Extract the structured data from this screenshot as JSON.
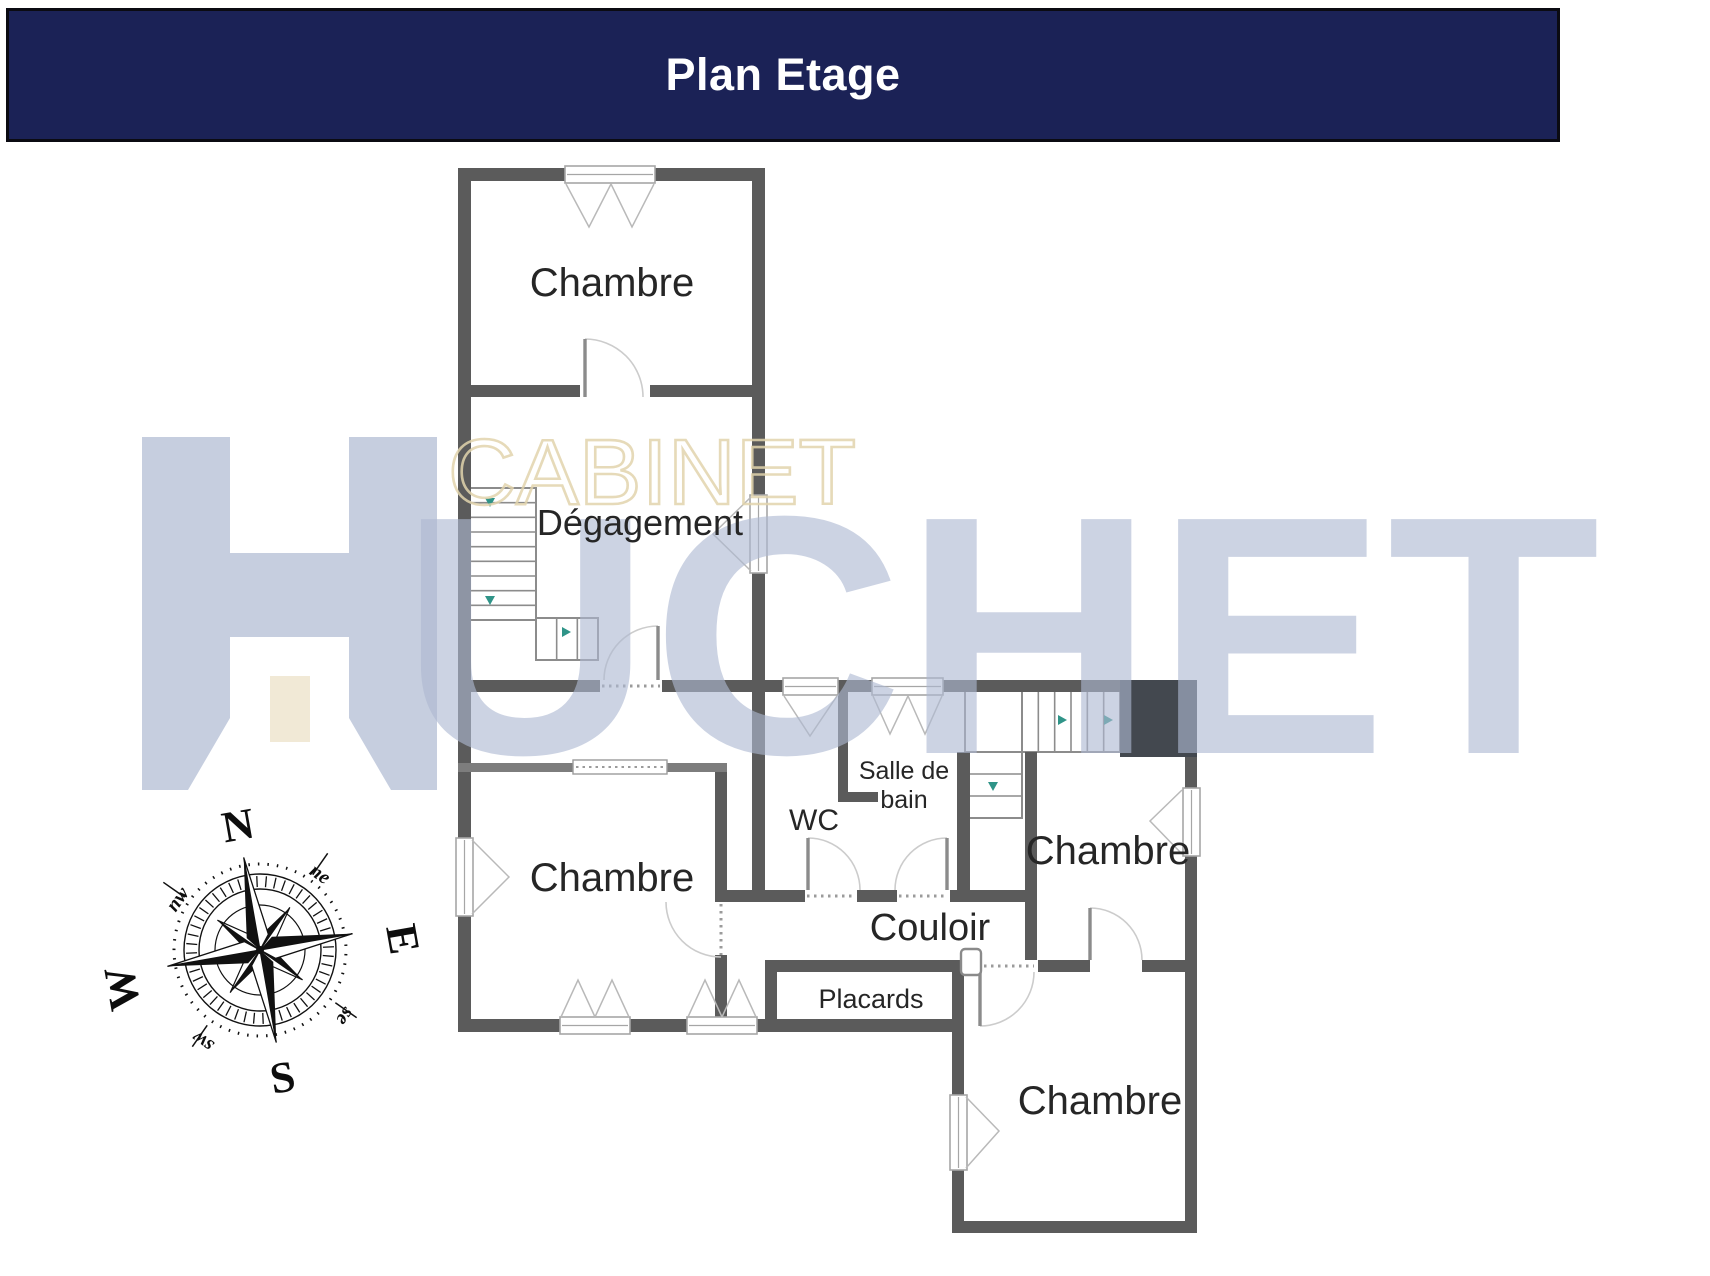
{
  "header": {
    "title": "Plan Etage",
    "bg": "#1b2256",
    "text_color": "#ffffff"
  },
  "watermark": {
    "word_top": "CABINET",
    "logo_letter": "H",
    "word_main_rest": "UCHET",
    "cream_color": "#e2d4ad",
    "blue_color": "#aeb9d2",
    "door_color": "#f0e8d4"
  },
  "compass": {
    "cx": 260,
    "cy": 950,
    "rotation": -10,
    "cardinals": {
      "n": "N",
      "e": "E",
      "s": "S",
      "w": "W"
    },
    "intercardinals": {
      "ne": "ne",
      "se": "se",
      "sw": "sw",
      "nw": "nw"
    }
  },
  "plan": {
    "wall_color": "#5b5b5b",
    "light_wall_color": "#7d7d7d",
    "block_color": "#43484f",
    "label_color": "#262626",
    "arrow_color": "#2f9488",
    "arc_color": "#cccccc",
    "leaf_color": "#8b8b8b",
    "frame_color": "#a6a6a6",
    "walls": [
      [
        458,
        168,
        307,
        13
      ],
      [
        458,
        168,
        13,
        670
      ],
      [
        458,
        916,
        13,
        115
      ],
      [
        752,
        168,
        13,
        327
      ],
      [
        752,
        573,
        13,
        317
      ],
      [
        458,
        385,
        122,
        12
      ],
      [
        650,
        385,
        115,
        12
      ],
      [
        458,
        680,
        142,
        12
      ],
      [
        662,
        680,
        121,
        12
      ],
      [
        838,
        680,
        34,
        12
      ],
      [
        943,
        680,
        254,
        12
      ],
      [
        1185,
        680,
        12,
        108
      ],
      [
        1185,
        856,
        12,
        377
      ],
      [
        838,
        692,
        10,
        110
      ],
      [
        838,
        792,
        40,
        10
      ],
      [
        957,
        752,
        13,
        138
      ],
      [
        715,
        763,
        12,
        139
      ],
      [
        715,
        955,
        12,
        67
      ],
      [
        715,
        890,
        90,
        12
      ],
      [
        857,
        890,
        40,
        12
      ],
      [
        950,
        890,
        80,
        12
      ],
      [
        765,
        972,
        12,
        50
      ],
      [
        765,
        960,
        210,
        12
      ],
      [
        1038,
        960,
        52,
        12
      ],
      [
        1142,
        960,
        55,
        12
      ],
      [
        458,
        1019,
        102,
        13
      ],
      [
        630,
        1019,
        57,
        13
      ],
      [
        757,
        1019,
        207,
        13
      ],
      [
        952,
        972,
        12,
        123
      ],
      [
        952,
        1170,
        12,
        63
      ],
      [
        952,
        1221,
        245,
        12
      ],
      [
        1025,
        752,
        12,
        208
      ]
    ],
    "light_walls": [
      [
        458,
        763,
        115,
        9
      ],
      [
        667,
        763,
        60,
        9
      ]
    ],
    "block": [
      1120,
      680,
      77,
      77
    ],
    "stairs": [
      {
        "x": 466,
        "y": 488,
        "w": 70,
        "h": 132,
        "dir": "h",
        "n": 8
      },
      {
        "x": 536,
        "y": 618,
        "w": 62,
        "h": 42,
        "dir": "v",
        "n": 2
      },
      {
        "x": 965,
        "y": 690,
        "w": 57,
        "h": 62,
        "dir": "h",
        "n": 0
      },
      {
        "x": 1022,
        "y": 690,
        "w": 98,
        "h": 62,
        "dir": "v",
        "n": 5
      },
      {
        "x": 965,
        "y": 752,
        "w": 57,
        "h": 66,
        "dir": "h",
        "n": 2
      }
    ],
    "windows": [
      {
        "rect": [
          565,
          166,
          90,
          17
        ],
        "sashes": [
          "M566,184 L589,227 L611,184",
          "M611,184 L632,227 L654,184"
        ]
      },
      {
        "rect": [
          750,
          495,
          17,
          78
        ],
        "sashes": [
          "M751,497 L713,534 L751,571"
        ]
      },
      {
        "rect": [
          456,
          838,
          17,
          78
        ],
        "sashes": [
          "M472,840 L509,877 L472,914"
        ]
      },
      {
        "rect": [
          783,
          678,
          55,
          17
        ],
        "sashes": [
          "M784,696 L810,736 L837,696"
        ]
      },
      {
        "rect": [
          872,
          678,
          71,
          17
        ],
        "sashes": [
          "M873,696 L890,734 L908,696",
          "M908,696 L925,734 L942,696"
        ]
      },
      {
        "rect": [
          1183,
          788,
          17,
          68
        ],
        "sashes": [
          "M1182,790 L1150,821 L1182,854"
        ]
      },
      {
        "rect": [
          560,
          1017,
          70,
          17
        ],
        "sashes": [
          "M561,1017 L578,980 L595,1017",
          "M595,1017 L612,980 L629,1017"
        ]
      },
      {
        "rect": [
          687,
          1017,
          70,
          17
        ],
        "sashes": [
          "M688,1017 L705,980 L722,1017",
          "M722,1017 L739,980 L756,1017"
        ]
      },
      {
        "rect": [
          950,
          1095,
          17,
          75
        ],
        "sashes": [
          "M966,1097 L999,1131 L966,1168"
        ]
      }
    ],
    "doors": [
      {
        "leaf": [
          585,
          397,
          585,
          339
        ],
        "arc": "M643,397 A58,58 0 0 0 585,339"
      },
      {
        "leaf": [
          658,
          680,
          658,
          626
        ],
        "arc": "M604,680 A54,54 0 0 1 658,626"
      },
      {
        "leaf": [
          808,
          838,
          808,
          890
        ],
        "arc": "M808,838 A52,52 0 0 1 860,890"
      },
      {
        "leaf": [
          947,
          838,
          947,
          890
        ],
        "arc": "M947,838 A52,52 0 0 0 895,890"
      },
      {
        "leaf": null,
        "arc": "M666,902 A55,55 0 0 0 721,957"
      },
      {
        "leaf": [
          980,
          972,
          980,
          1026
        ],
        "arc": "M980,1026 A54,54 0 0 0 1034,972"
      },
      {
        "leaf": [
          1090,
          960,
          1090,
          908
        ],
        "arc": "M1090,908 A52,52 0 0 1 1142,960"
      }
    ],
    "dotted": [
      [
        602,
        686,
        660,
        686
      ],
      [
        807,
        896,
        855,
        896
      ],
      [
        899,
        896,
        947,
        896
      ],
      [
        721,
        904,
        721,
        955
      ],
      [
        977,
        966,
        1034,
        966
      ]
    ],
    "cased_opening": {
      "rect": [
        573,
        760,
        94,
        14
      ]
    },
    "niche": [
      961,
      949,
      20,
      26
    ],
    "arrows": [
      [
        490,
        502,
        "d"
      ],
      [
        490,
        600,
        "d"
      ],
      [
        566,
        632,
        "r"
      ],
      [
        1062,
        720,
        "r"
      ],
      [
        1108,
        720,
        "r"
      ],
      [
        993,
        786,
        "d"
      ]
    ],
    "labels": [
      {
        "id": "room-chambre-nord",
        "text": "Chambre",
        "x": 612,
        "y": 296,
        "size": 40
      },
      {
        "id": "room-degagement",
        "text": "Dégagement",
        "x": 640,
        "y": 535,
        "size": 36
      },
      {
        "id": "room-chambre-ouest",
        "text": "Chambre",
        "x": 612,
        "y": 891,
        "size": 40
      },
      {
        "id": "room-wc",
        "text": "WC",
        "x": 814,
        "y": 830,
        "size": 30
      },
      {
        "id": "room-salle-de-bain-l1",
        "text": "Salle de",
        "x": 904,
        "y": 779,
        "size": 25
      },
      {
        "id": "room-salle-de-bain-l2",
        "text": "bain",
        "x": 904,
        "y": 808,
        "size": 25
      },
      {
        "id": "room-couloir",
        "text": "Couloir",
        "x": 930,
        "y": 940,
        "size": 38
      },
      {
        "id": "room-placards",
        "text": "Placards",
        "x": 871,
        "y": 1008,
        "size": 27
      },
      {
        "id": "room-chambre-est",
        "text": "Chambre",
        "x": 1108,
        "y": 864,
        "size": 40
      },
      {
        "id": "room-chambre-sud",
        "text": "Chambre",
        "x": 1100,
        "y": 1114,
        "size": 40
      }
    ]
  }
}
